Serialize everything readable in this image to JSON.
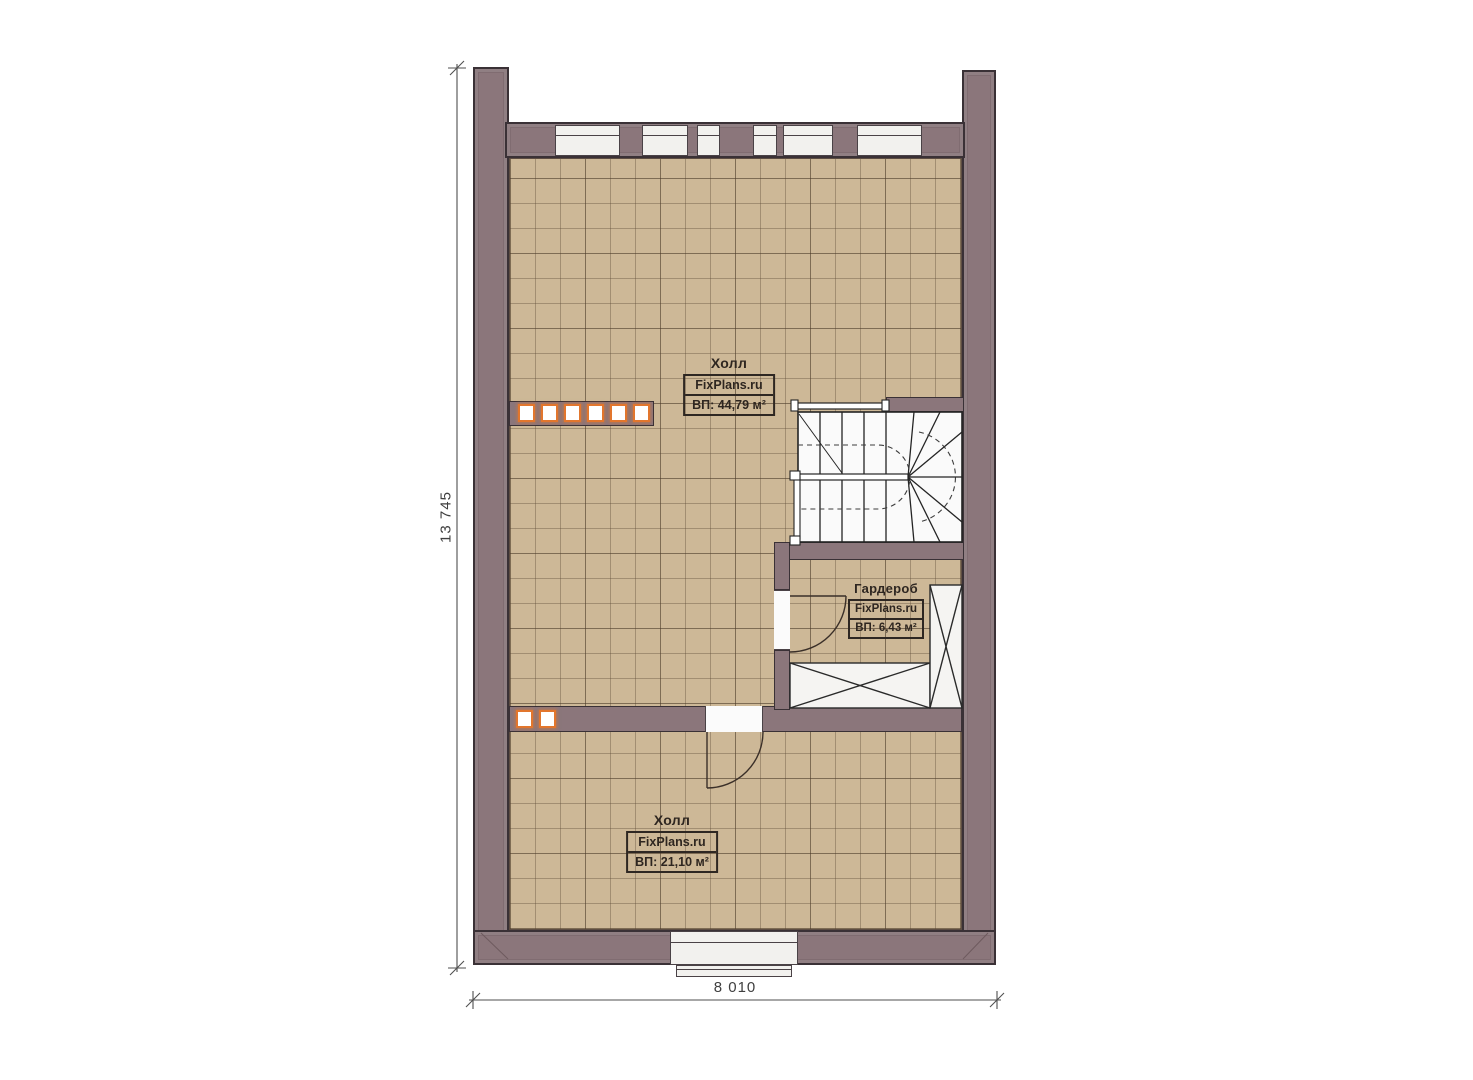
{
  "plan": {
    "rooms": [
      {
        "name": "Холл",
        "brand": "FixPlans.ru",
        "area": "ВП: 44,79 м²"
      },
      {
        "name": "Гардероб",
        "brand": "FixPlans.ru",
        "area": "ВП: 6,43 м²"
      },
      {
        "name": "Холл",
        "brand": "FixPlans.ru",
        "area": "ВП: 21,10 м²"
      }
    ],
    "dimensions": {
      "vertical": "13 745",
      "horizontal": "8 010"
    },
    "colors": {
      "wall_fill": "#8b767b",
      "wall_edge": "#3a3136",
      "floor_tile": "#cdb897",
      "glass_block_border": "#e2762d",
      "stair_fill": "#fafafa",
      "dimension_line": "#4f4f4f"
    }
  }
}
